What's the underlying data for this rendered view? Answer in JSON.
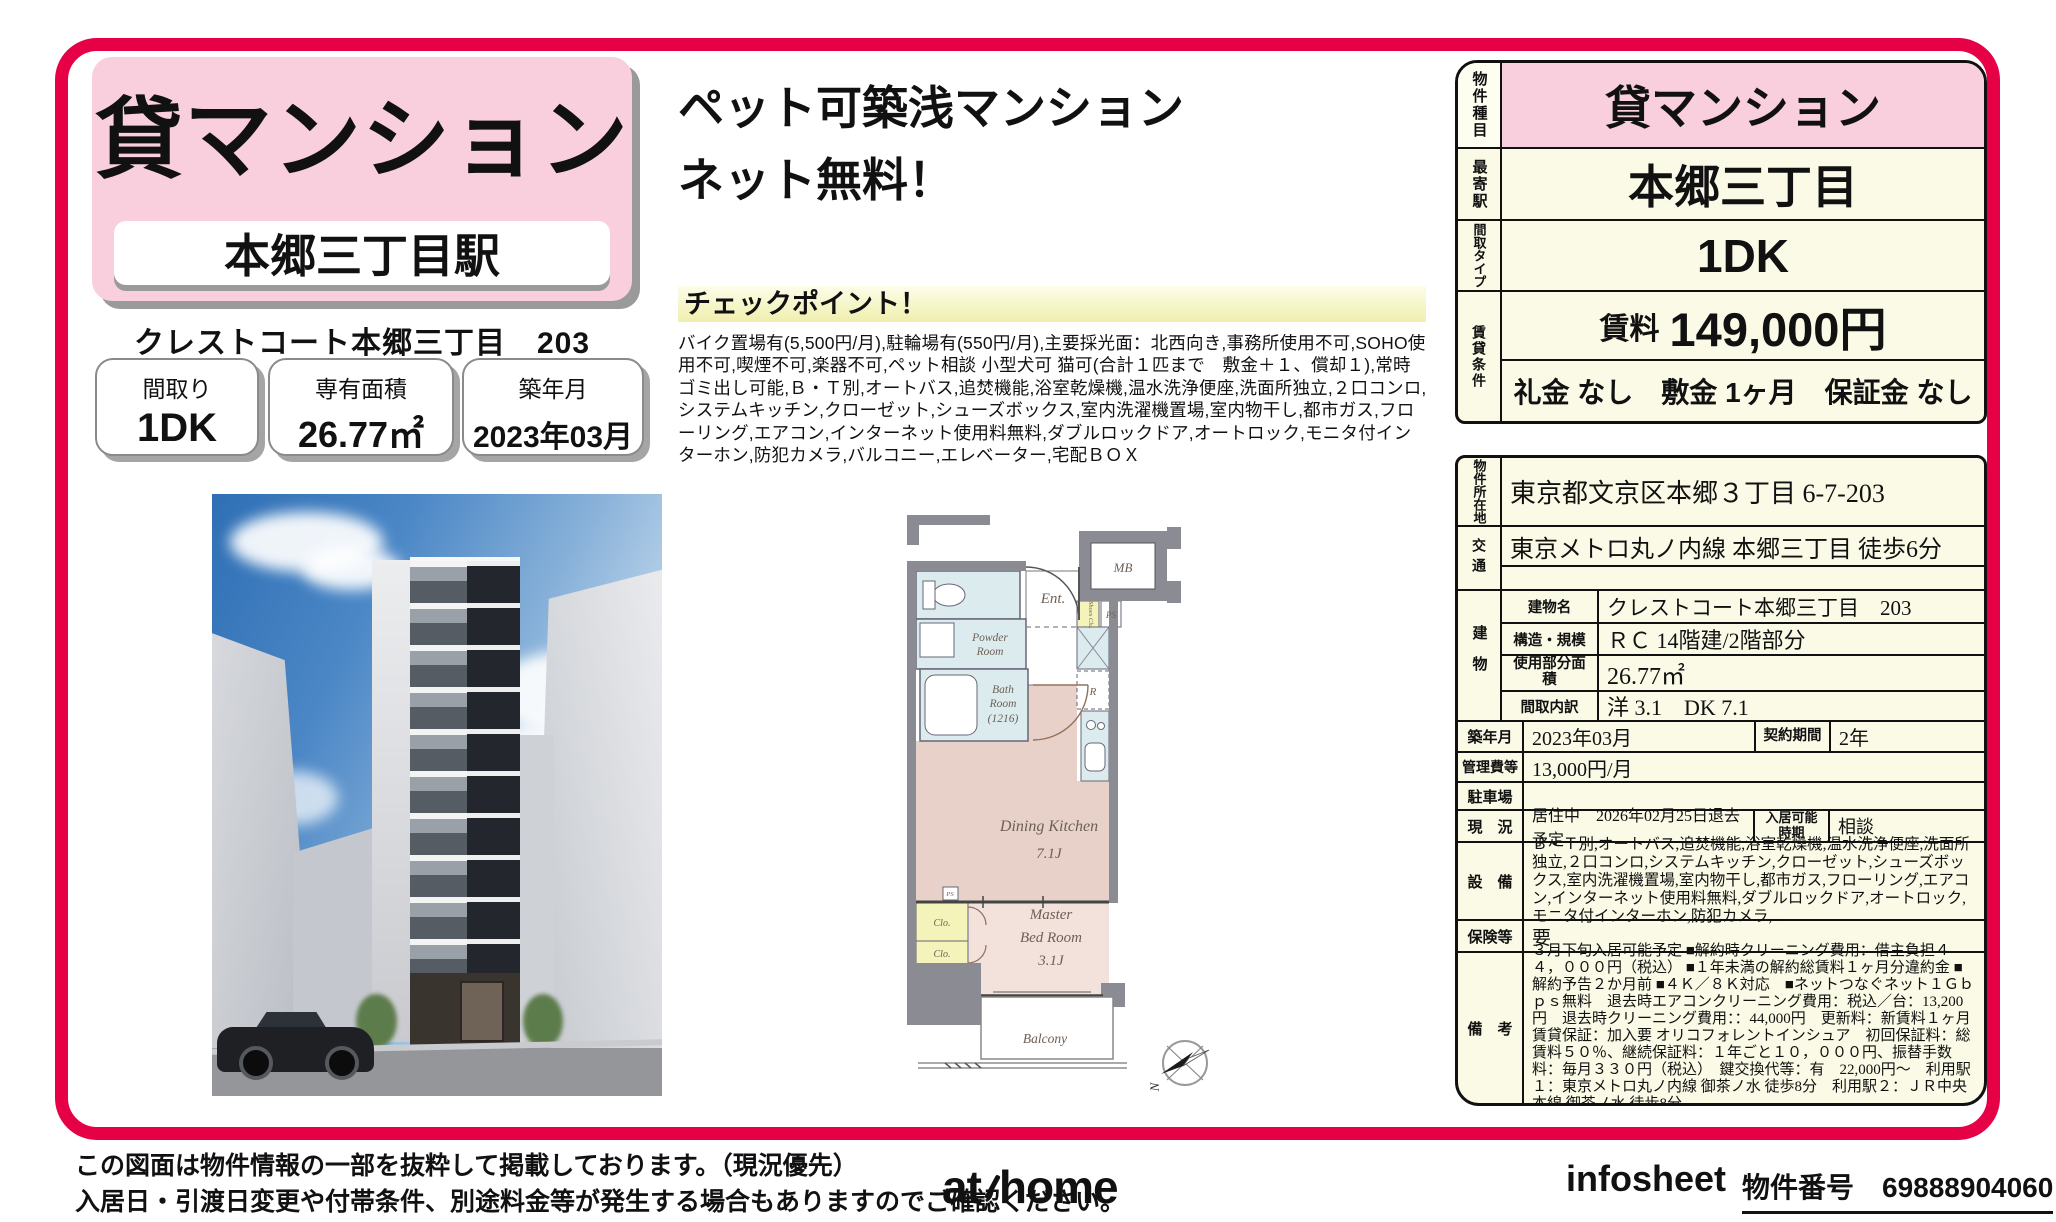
{
  "colors": {
    "accent": "#e60045",
    "pink": "#f9cfdd",
    "cream": "#fafae6",
    "checkpoint_yellow": "#efefae"
  },
  "left": {
    "category": "貸マンション",
    "station": "本郷三丁目駅",
    "building_line": "クレストコート本郷三丁目　203",
    "stats": [
      {
        "label": "間取り",
        "value": "1DK"
      },
      {
        "label": "専有面積",
        "value": "26.77㎡"
      },
      {
        "label": "築年月",
        "value": "2023年03月"
      }
    ]
  },
  "center": {
    "headline1": "ペット可築浅マンション",
    "headline2": "ネット無料！",
    "checkpoint_title": "チェックポイント！",
    "checkpoint_body": "バイク置場有(5,500円/月),駐輪場有(550円/月),主要採光面：北西向き,事務所使用不可,SOHO使用不可,喫煙不可,楽器不可,ペット相談 小型犬可 猫可(合計１匹まで　敷金＋１、償却１),常時ゴミ出し可能,Ｂ・Ｔ別,オートバス,追焚機能,浴室乾燥機,温水洗浄便座,洗面所独立,２口コンロ,システムキッチン,クローゼット,シューズボックス,室内洗濯機置場,室内物干し,都市ガス,フローリング,エアコン,インターネット使用料無料,ダブルロックドア,オートロック,モニタ付インターホン,防犯カメラ,バルコニー,エレベーター,宅配ＢＯＸ"
  },
  "floorplan": {
    "ent": "Ent.",
    "mb": "MB",
    "shoes": "Shoes Clo.",
    "ps": "PS",
    "ps2": "PS",
    "powder1": "Powder",
    "powder2": "Room",
    "bath1": "Bath",
    "bath2": "Room",
    "bath3": "(1216)",
    "r": "R",
    "dk1": "Dining Kitchen",
    "dk2": "7.1J",
    "bed1": "Master",
    "bed2": "Bed Room",
    "bed3": "3.1J",
    "clo1": "Clo.",
    "clo2": "Clo.",
    "balcony": "Balcony",
    "north_letter": "N"
  },
  "summary": {
    "property_type_label": "物件種目",
    "property_type": "貸マンション",
    "station_label": "最寄駅",
    "station": "本郷三丁目",
    "layout_label": "間取タイプ",
    "layout": "1DK",
    "terms_label": "賃貸条件",
    "rent_label": "賃料",
    "rent": "149,000円",
    "terms": "礼金 なし　敷金 1ヶ月　保証金 なし"
  },
  "detail": {
    "address_label": "物件所在地",
    "address": "東京都文京区本郷３丁目 6-7-203",
    "traffic_label": "交通",
    "traffic1": "東京メトロ丸ノ内線 本郷三丁目 徒歩6分",
    "traffic2": "",
    "building_label": "建物",
    "building_rows": [
      {
        "label": "建物名",
        "value": "クレストコート本郷三丁目　203"
      },
      {
        "label": "構造・規模",
        "value": "ＲＣ 14階建/2階部分"
      },
      {
        "label": "使用部分面積",
        "value": "26.77㎡"
      },
      {
        "label": "間取内訳",
        "value": "洋 3.1　DK 7.1"
      }
    ],
    "built_label": "築年月",
    "built": "2023年03月",
    "contract_label": "契約期間",
    "contract": "2年",
    "fee_label": "管理費等",
    "fee": "13,000円/月",
    "parking_label": "駐車場",
    "parking": "",
    "status_label": "現　況",
    "status": "居住中　2026年02月25日退去予定",
    "movein_label": "入居可能時期",
    "movein": "相談",
    "equip_label": "設　備",
    "equip": "Ｂ・Ｔ別,オートバス,追焚機能,浴室乾燥機,温水洗浄便座,洗面所独立,２口コンロ,システムキッチン,クローゼット,シューズボックス,室内洗濯機置場,室内物干し,都市ガス,フローリング,エアコン,インターネット使用料無料,ダブルロックドア,オートロック,モニタ付インターホン,防犯カメラ,...",
    "insurance_label": "保険等",
    "insurance": "要",
    "notes_label": "備　考",
    "notes": "３月下旬入居可能予定 ■解約時クリーニング費用：借主負担４４，０００円（税込） ■１年未満の解約総賃料１ヶ月分違約金 ■解約予告２か月前 ■４Ｋ／８Ｋ対応　■ネットつなぐネット１Ｇｂｐｓ無料　退去時エアコンクリーニング費用：税込／台：13,200円　退去時クリーニング費用：：44,000円　更新料：新賃料１ヶ月　賃貸保証：加入要 オリコフォレントインシュア　初回保証料：総賃料５０％、継続保証料：１年ごと１０，０００円、振替手数料：毎月３３０円（税込）　鍵交換代等：有　22,000円～　利用駅１：東京メトロ丸ノ内線 御茶ノ水 徒歩8分　利用駅２：ＪＲ中央本線 御茶ノ水 徒歩8分"
  },
  "footer": {
    "disclaimer1": "この図面は物件情報の一部を抜粋して掲載しております。（現況優先）",
    "disclaimer2": "入居日・引渡日変更や付帯条件、別途料金等が発生する場合もありますのでご確認ください。",
    "logo_at": "at",
    "logo_home": "home",
    "infosheet": "infosheet",
    "property_no_label": "物件番号",
    "property_no": "69888904060"
  }
}
